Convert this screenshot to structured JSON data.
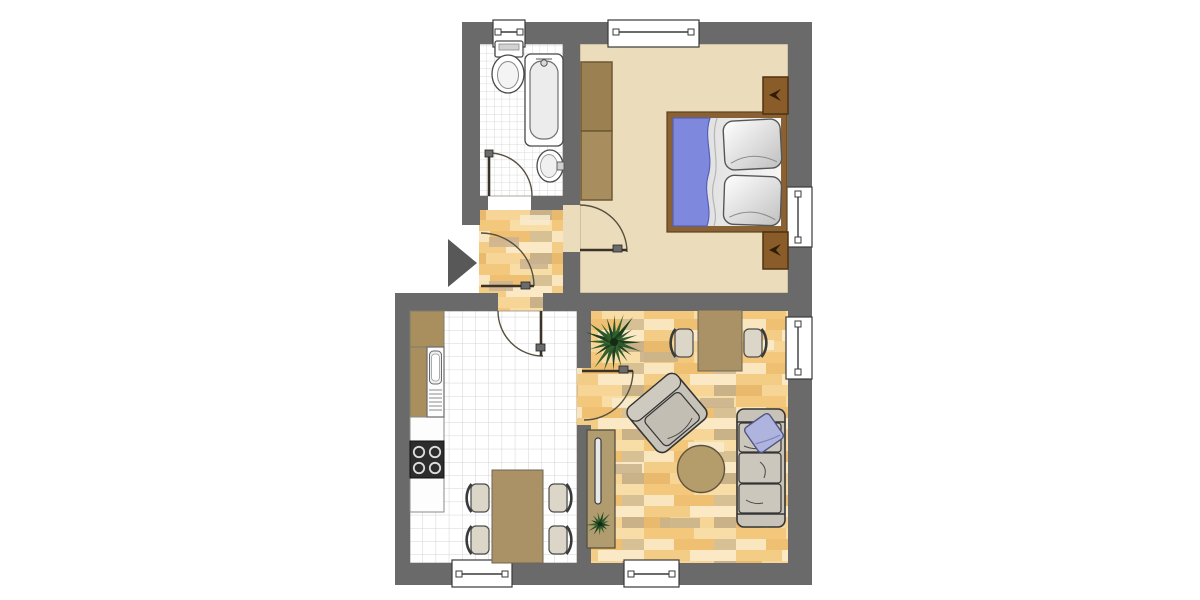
{
  "title": "apartment-floor-plan",
  "colors": {
    "background": "#ffffff",
    "wall": "#6a6a6a",
    "bedroom_floor": "#ebddbc",
    "parquet_base": "#f2c77d",
    "parquet_shades": [
      "#f4c87c",
      "#f8dda6",
      "#f9e6bf",
      "#efbf72",
      "#d7c194",
      "#fbe9c6",
      "#c8b28b"
    ],
    "tile_line": "#d6d6d6",
    "furniture_tan": "#ab9266",
    "bed_frame_brown": "#8a6133",
    "wardrobe_brown": "#a28756",
    "nightstand_brown": "#8a5c2a",
    "blanket_blue": "#7e88dc",
    "pillow_lavender": "#aeb4de",
    "sofa_gray": "#c7c3b9",
    "chair_beige": "#dcd6c8",
    "plant_green": "#2d572d",
    "door_arc": "#56503e",
    "entrance_arrow": "#585858"
  },
  "scene": {
    "rooms": [
      {
        "name": "bathroom",
        "floor": "small-tiles",
        "furniture": [
          "toilet",
          "bathtub",
          "sink"
        ],
        "windows": 1
      },
      {
        "name": "bedroom",
        "floor": "beige",
        "furniture": [
          "double-bed",
          "wardrobe",
          "nightstand",
          "nightstand"
        ],
        "windows": 2
      },
      {
        "name": "hallway",
        "floor": "parquet",
        "furniture": [],
        "windows": 0
      },
      {
        "name": "kitchen",
        "floor": "tiles",
        "furniture": [
          "counter",
          "kitchen-sink",
          "stove",
          "dining-table",
          "chair",
          "chair",
          "chair",
          "chair"
        ],
        "windows": 1
      },
      {
        "name": "living-room",
        "floor": "parquet",
        "furniture": [
          "table",
          "chair",
          "chair",
          "armchair",
          "round-table",
          "sofa",
          "pillow",
          "sideboard",
          "large-plant",
          "small-plant"
        ],
        "windows": 2
      }
    ],
    "doors": 5,
    "entrance_marker": "black-triangle-arrow"
  },
  "plan": {
    "chairs": [
      {
        "x": 467,
        "y": 481,
        "back": "left",
        "room": "kitchen"
      },
      {
        "x": 467,
        "y": 523,
        "back": "left",
        "room": "kitchen"
      },
      {
        "x": 545,
        "y": 481,
        "back": "right",
        "room": "kitchen"
      },
      {
        "x": 545,
        "y": 523,
        "back": "right",
        "room": "kitchen"
      },
      {
        "x": 671,
        "y": 326,
        "back": "left",
        "room": "living"
      },
      {
        "x": 740,
        "y": 326,
        "back": "right",
        "room": "living"
      }
    ],
    "plants": [
      {
        "cx": 614,
        "cy": 342,
        "leaves": 20,
        "rmin": 22,
        "rmax": 33,
        "core": 4,
        "name": "large-plant"
      },
      {
        "cx": 600,
        "cy": 524,
        "leaves": 13,
        "rmin": 9,
        "rmax": 15,
        "core": 2.5,
        "name": "small-plant"
      }
    ]
  }
}
